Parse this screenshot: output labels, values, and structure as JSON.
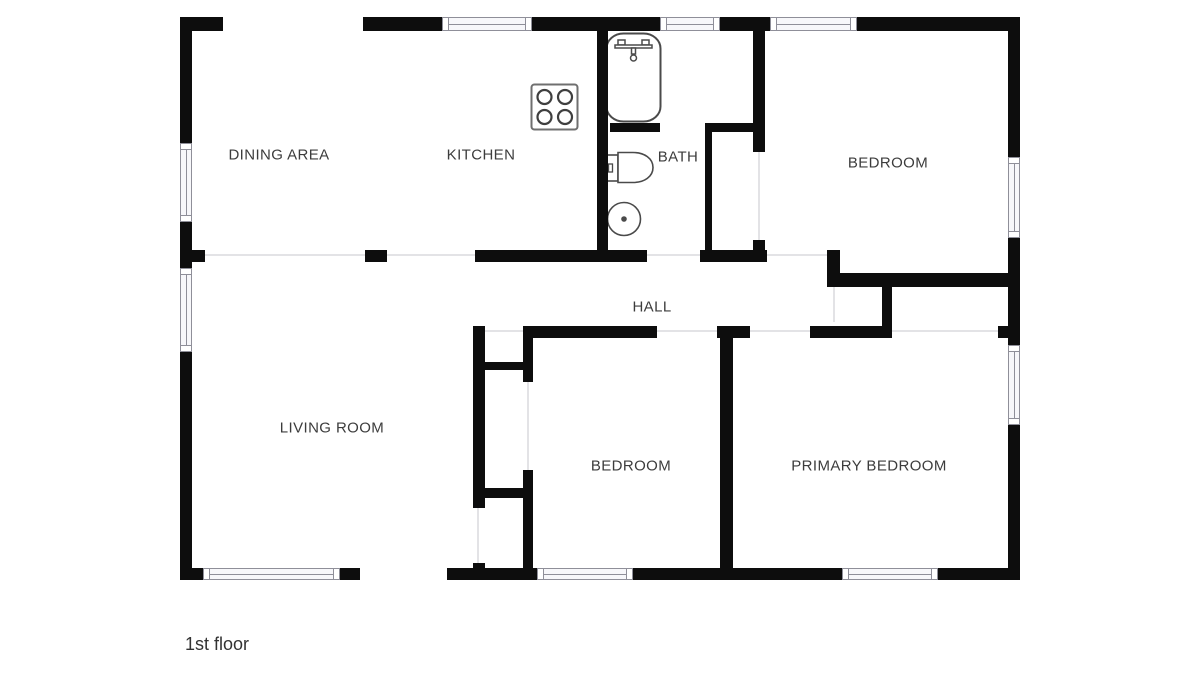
{
  "plan_title": "1st floor",
  "colors": {
    "wall": "#0d0d0d",
    "background": "#ffffff",
    "window_fill": "#f7f7fa",
    "window_frame": "#8f8f99",
    "opening_line": "#e3e3e6",
    "fixture_stroke": "#4a4a4a",
    "label_text": "#3c3c3c"
  },
  "rooms": [
    {
      "id": "dining-area",
      "label": "DINING AREA",
      "x": 279,
      "y": 155
    },
    {
      "id": "kitchen",
      "label": "KITCHEN",
      "x": 481,
      "y": 155
    },
    {
      "id": "bath",
      "label": "BATH",
      "x": 678,
      "y": 157
    },
    {
      "id": "bedroom-top",
      "label": "BEDROOM",
      "x": 888,
      "y": 163
    },
    {
      "id": "hall",
      "label": "HALL",
      "x": 652,
      "y": 307
    },
    {
      "id": "living-room",
      "label": "LIVING ROOM",
      "x": 332,
      "y": 428
    },
    {
      "id": "bedroom-bottom",
      "label": "BEDROOM",
      "x": 631,
      "y": 466
    },
    {
      "id": "primary-bedroom",
      "label": "PRIMARY BEDROOM",
      "x": 869,
      "y": 466
    }
  ],
  "floor_label": {
    "text": "1st floor",
    "x": 185,
    "y": 634
  },
  "fixtures": [
    "stove-icon",
    "bathtub-icon",
    "toilet-icon",
    "sink-icon"
  ],
  "geometry": {
    "walls": [
      [
        180,
        17,
        43,
        14
      ],
      [
        363,
        17,
        79,
        14
      ],
      [
        532,
        17,
        128,
        14
      ],
      [
        720,
        17,
        50,
        14
      ],
      [
        857,
        17,
        163,
        14
      ],
      [
        180,
        17,
        12,
        126
      ],
      [
        180,
        222,
        12,
        46
      ],
      [
        180,
        352,
        12,
        228
      ],
      [
        1008,
        17,
        12,
        140
      ],
      [
        1008,
        238,
        12,
        107
      ],
      [
        1008,
        425,
        12,
        155
      ],
      [
        192,
        250,
        13,
        12
      ],
      [
        365,
        250,
        22,
        12
      ],
      [
        475,
        250,
        172,
        12
      ],
      [
        700,
        250,
        67,
        12
      ],
      [
        827,
        250,
        13,
        37
      ],
      [
        597,
        31,
        11,
        219
      ],
      [
        705,
        123,
        7,
        139
      ],
      [
        610,
        123,
        50,
        9
      ],
      [
        707,
        123,
        58,
        9
      ],
      [
        753,
        31,
        12,
        121
      ],
      [
        753,
        240,
        12,
        22
      ],
      [
        832,
        273,
        188,
        14
      ],
      [
        882,
        287,
        10,
        51
      ],
      [
        473,
        326,
        12,
        12
      ],
      [
        523,
        326,
        134,
        12
      ],
      [
        717,
        326,
        33,
        12
      ],
      [
        810,
        326,
        82,
        12
      ],
      [
        998,
        326,
        22,
        12
      ],
      [
        473,
        326,
        12,
        182
      ],
      [
        473,
        563,
        12,
        17
      ],
      [
        523,
        326,
        10,
        56
      ],
      [
        523,
        470,
        10,
        110
      ],
      [
        473,
        362,
        60,
        8
      ],
      [
        473,
        488,
        60,
        10
      ],
      [
        720,
        326,
        13,
        254
      ],
      [
        180,
        568,
        23,
        12
      ],
      [
        340,
        568,
        20,
        12
      ],
      [
        447,
        568,
        90,
        12
      ],
      [
        633,
        568,
        209,
        12
      ],
      [
        938,
        568,
        82,
        12
      ]
    ],
    "windows": [
      [
        442,
        17,
        90,
        14
      ],
      [
        660,
        17,
        60,
        14
      ],
      [
        770,
        17,
        87,
        14
      ],
      [
        180,
        143,
        12,
        79
      ],
      [
        180,
        268,
        12,
        84
      ],
      [
        1008,
        157,
        12,
        81
      ],
      [
        1008,
        345,
        12,
        80
      ],
      [
        203,
        568,
        137,
        12
      ],
      [
        537,
        568,
        96,
        12
      ],
      [
        842,
        568,
        96,
        12
      ]
    ],
    "openings": [
      [
        205,
        254,
        160,
        2
      ],
      [
        387,
        254,
        88,
        2
      ],
      [
        647,
        254,
        53,
        2
      ],
      [
        767,
        254,
        60,
        2
      ],
      [
        485,
        330,
        38,
        2
      ],
      [
        657,
        330,
        60,
        2
      ],
      [
        750,
        330,
        60,
        2
      ],
      [
        892,
        330,
        106,
        2
      ],
      [
        477,
        508,
        2,
        55
      ],
      [
        527,
        382,
        2,
        88
      ],
      [
        758,
        152,
        2,
        88
      ],
      [
        833,
        287,
        2,
        35
      ]
    ]
  }
}
